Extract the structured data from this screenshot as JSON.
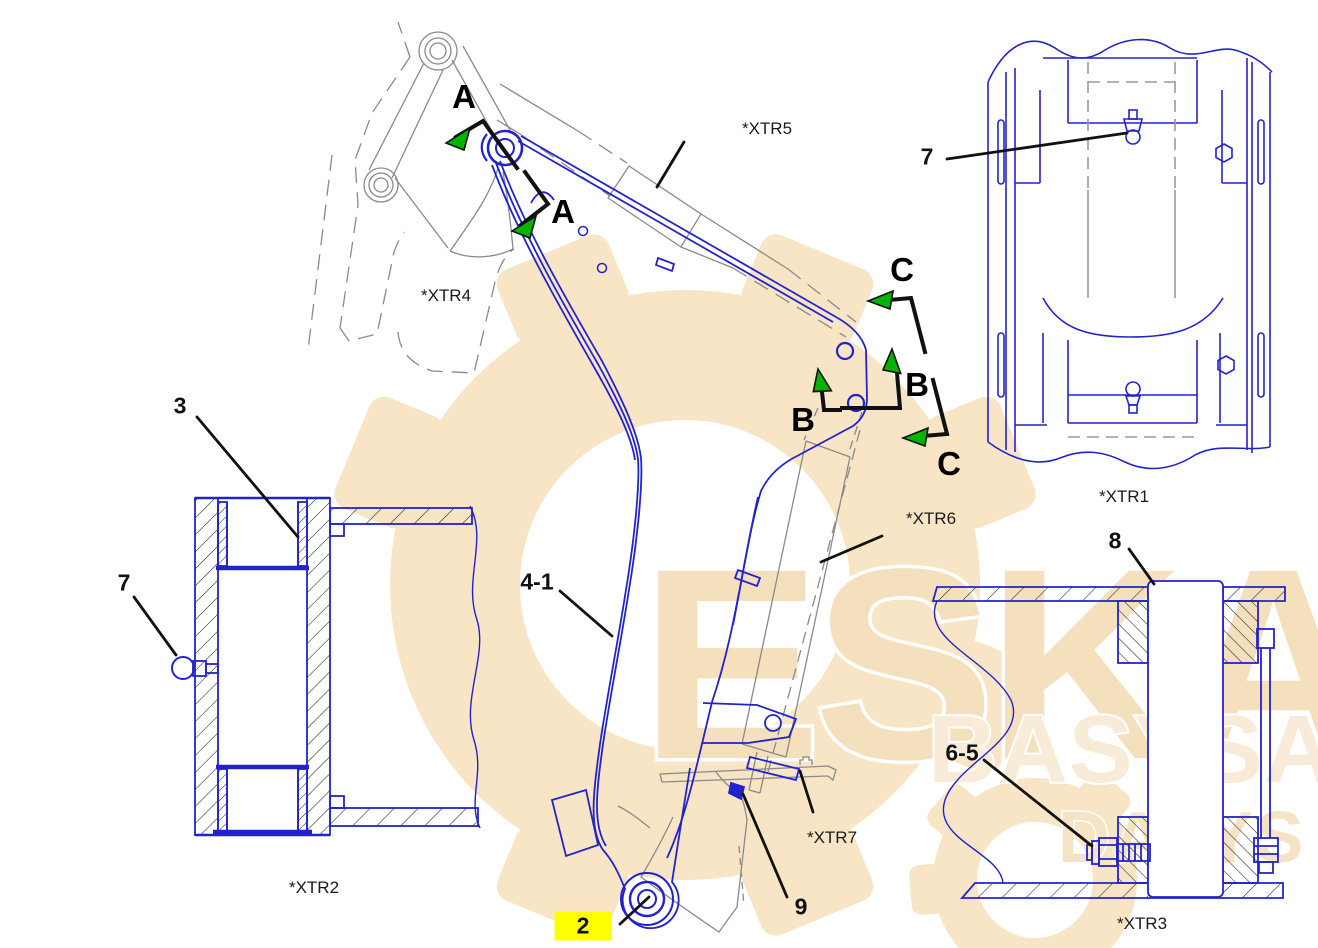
{
  "figure": {
    "type": "parts-exploded-diagram",
    "subject": "excavator stick group with section views",
    "colors": {
      "part_line": "#2323cc",
      "reference_line": "#8a8a8a",
      "leader": "#111111",
      "section_arrow": "#00b400",
      "highlight": "#ffff00",
      "watermark": "#f6e3c4"
    },
    "callouts": [
      {
        "label": "2",
        "highlighted": true
      },
      {
        "label": "3",
        "highlighted": false
      },
      {
        "label": "4-1",
        "highlighted": false
      },
      {
        "label": "6-5",
        "highlighted": false
      },
      {
        "label": "7",
        "highlighted": false
      },
      {
        "label": "7",
        "highlighted": false
      },
      {
        "label": "8",
        "highlighted": false
      },
      {
        "label": "9",
        "highlighted": false
      }
    ],
    "references": [
      {
        "label": "*XTR1"
      },
      {
        "label": "*XTR2"
      },
      {
        "label": "*XTR3"
      },
      {
        "label": "*XTR4"
      },
      {
        "label": "*XTR5"
      },
      {
        "label": "*XTR6"
      },
      {
        "label": "*XTR7"
      }
    ],
    "sections": [
      {
        "label": "A"
      },
      {
        "label": "A"
      },
      {
        "label": "B"
      },
      {
        "label": "B"
      },
      {
        "label": "C"
      },
      {
        "label": "C"
      }
    ],
    "watermark": {
      "primary": "ESKA",
      "secondary": "BASYSA",
      "tertiary": "DALYS"
    }
  }
}
